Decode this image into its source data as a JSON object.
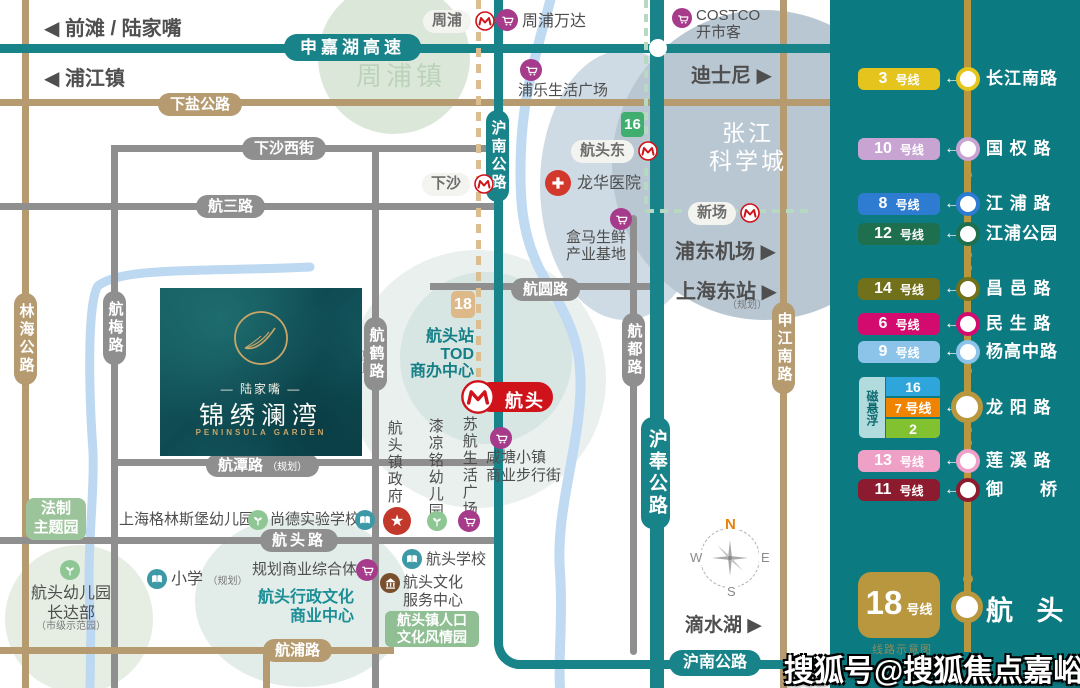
{
  "watermark": "搜狐号@搜狐焦点嘉峪关站",
  "colors": {
    "panel_bg": "#0c7a81",
    "teal_road": "#19838a",
    "tan_road": "#b59b6f",
    "gray_road": "#8f8f8f",
    "planned_line18": "#dcbd90",
    "line16_green": "#b7d9c4",
    "metro_red": "#d0121b",
    "gold": "#b9973e",
    "poi_purple": "#a63a8b",
    "poi_green": "#8fc794",
    "poi_blue": "#3e99a7",
    "hospital_red": "#d2382c",
    "badge_green": "#9cc49a",
    "map_line16_badge": "#3fae6e",
    "map_line18_badge": "#ddb98a"
  },
  "map": {
    "nav": {
      "qiantan": "◀ 前滩 / 陆家嘴",
      "pujiang": "◀ 浦江镇",
      "disney": "迪士尼 ▶",
      "pudong_airport": "浦东机场 ▶",
      "shanghai_east": "上海东站 ▶",
      "shanghai_east_note": "（规划）",
      "dishui_lake": "滴水湖 ▶"
    },
    "areas": {
      "zhoupu_town": "周浦镇",
      "zhangjiang": "张江\n科学城"
    },
    "roads": {
      "shenjiahu": "申嘉湖高速",
      "xiayan": "下盐公路",
      "xiasha_west": "下沙西街",
      "hangsan": "航三路",
      "hangyuan": "航圆路",
      "hangtan": "航潭路",
      "hangtan_note": "（规划）",
      "hangtou": "航头路",
      "hangpu": "航浦路",
      "hunan_vertical": "沪南公路",
      "hunan_bottom": "沪南公路",
      "hufeng": "沪奉公路",
      "linhai": "林海公路",
      "hangmei": "航梅路",
      "hanghe": "航鹤路",
      "hanghe_note": "规划",
      "hangdu": "航都路",
      "shenjiang_south": "申江南路"
    },
    "stations": {
      "zhoupu": "周浦",
      "xiasha": "下沙",
      "hangtou_east": "航头东",
      "xinchang": "新场",
      "hangtou": "航头",
      "line16_badge": "16",
      "line18_badge": "18"
    },
    "pois": {
      "zhoupu_wanda": "周浦万达",
      "pule_plaza": "浦乐生活广场",
      "costco": "COSTCO\n开市客",
      "longhua_hospital": "龙华医院",
      "hema": "盒马生鲜\n产业基地",
      "tod_center": "航头站\nTOD\n商办中心",
      "xiantang": "咸塘小镇\n商业步行街",
      "suhang_plaza": "苏航生活广场",
      "qiliangming_kg": "漆凉铭幼儿园",
      "town_government": "航头镇政府",
      "fazhi_park": "法制\n主题园",
      "greensburg_kg": "上海格林斯堡幼儿园",
      "shangde_school": "尚德实验学校",
      "primary_school": "小学",
      "primary_school_note": "（规划）",
      "planned_complex": "规划商业综合体",
      "admin_center": "航头行政文化\n商业中心",
      "hangtou_kg": "航头幼儿园\n长达部",
      "hangtou_kg_note": "（市级示范园）",
      "hangtou_school": "航头学校",
      "culture_center": "航头文化\n服务中心",
      "culture_park": "航头镇人口\n文化风情园"
    },
    "property": {
      "brand": "— 陆家嘴 —",
      "name": "锦绣澜湾",
      "name_en": "PENINSULA GARDEN"
    },
    "compass": {
      "n": "N",
      "e": "E",
      "s": "S",
      "w": "W"
    }
  },
  "metro_panel": {
    "arrow": "←",
    "note": "线路示意图",
    "rows": [
      {
        "num": "3",
        "unit": "号线",
        "station": "长江南路",
        "color": "#e4c41d"
      },
      {
        "num": "10",
        "unit": "号线",
        "station": "国 权 路",
        "color": "#c7a4d2"
      },
      {
        "num": "8",
        "unit": "号线",
        "station": "江 浦 路",
        "color": "#2e7cd2"
      },
      {
        "num": "12",
        "unit": "号线",
        "station": "江浦公园",
        "color": "#1d6f4e"
      },
      {
        "num": "14",
        "unit": "号线",
        "station": "昌 邑 路",
        "color": "#71701b"
      },
      {
        "num": "6",
        "unit": "号线",
        "station": "民 生 路",
        "color": "#d40b6e"
      },
      {
        "num": "9",
        "unit": "号线",
        "station": "杨高中路",
        "color": "#8cc3e8"
      },
      {
        "num": "13",
        "unit": "号线",
        "station": "莲 溪 路",
        "color": "#efa0c6"
      },
      {
        "num": "11",
        "unit": "号线",
        "station": "御　　桥",
        "color": "#8d1b30"
      }
    ],
    "maglev": {
      "label": "磁悬浮",
      "line16": "16",
      "line7": "7 号线",
      "line2": "2",
      "station": "龙 阳 路",
      "color_cell": "#b2dbdd",
      "color16": "#2ea6db",
      "color7": "#f08300",
      "color2": "#82c231"
    },
    "terminus": {
      "num": "18",
      "unit": "号线",
      "station": "航  头",
      "color": "#b9973e"
    }
  }
}
